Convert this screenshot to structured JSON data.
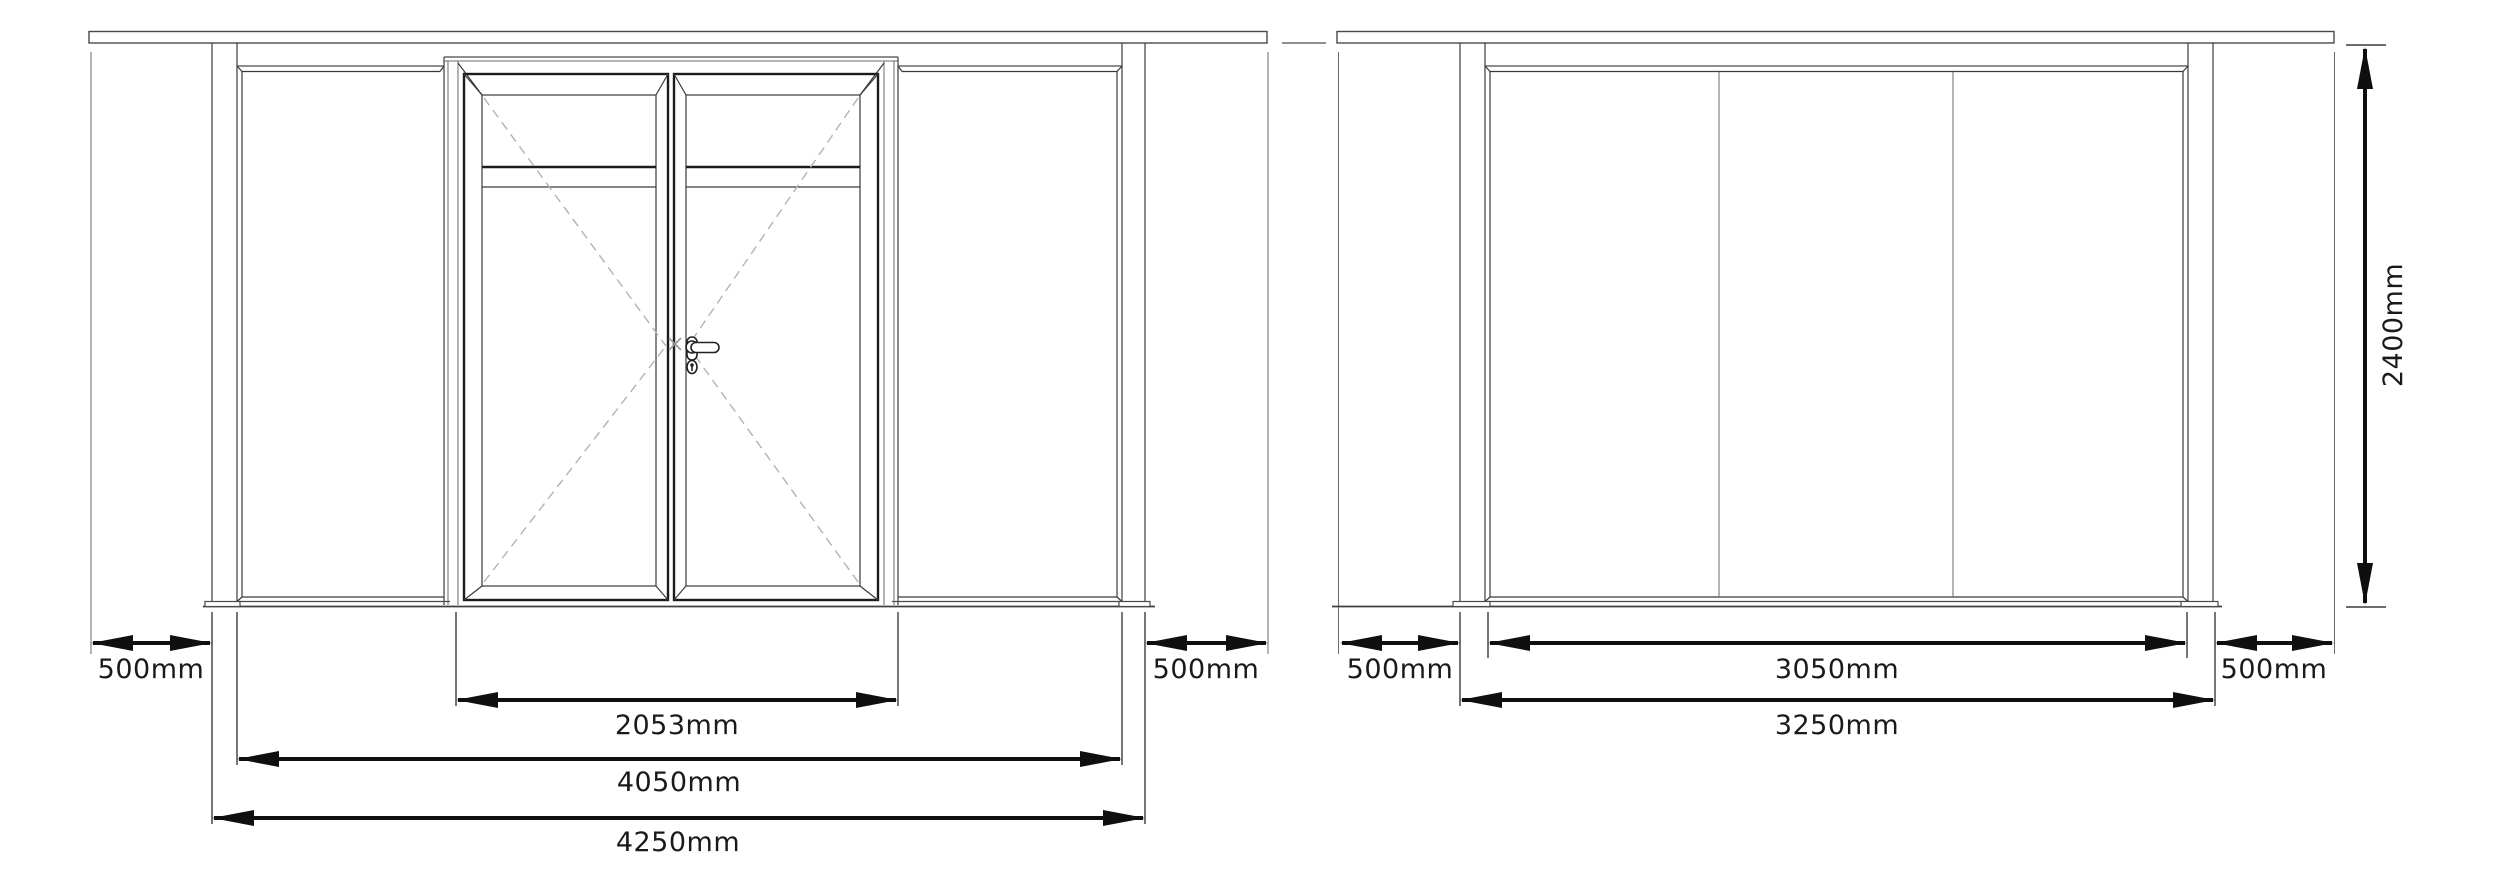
{
  "drawing": {
    "title": "glazed partition elevations",
    "left_elevation": {
      "description": "partition with double glass doors",
      "dims": {
        "side_left": "500mm",
        "door_width": "2053mm",
        "opening_width": "4050mm",
        "overall_width": "4250mm",
        "side_right": "500mm"
      }
    },
    "right_elevation": {
      "description": "three panel glazed partition",
      "dims": {
        "side_left": "500mm",
        "glass_width": "3050mm",
        "overall_width": "3250mm",
        "side_right": "500mm",
        "height": "2400mm"
      }
    },
    "colors": {
      "line": "#4a4a4a",
      "dimension": "#0f0f0f",
      "dashed": "#b3b3b3"
    }
  }
}
